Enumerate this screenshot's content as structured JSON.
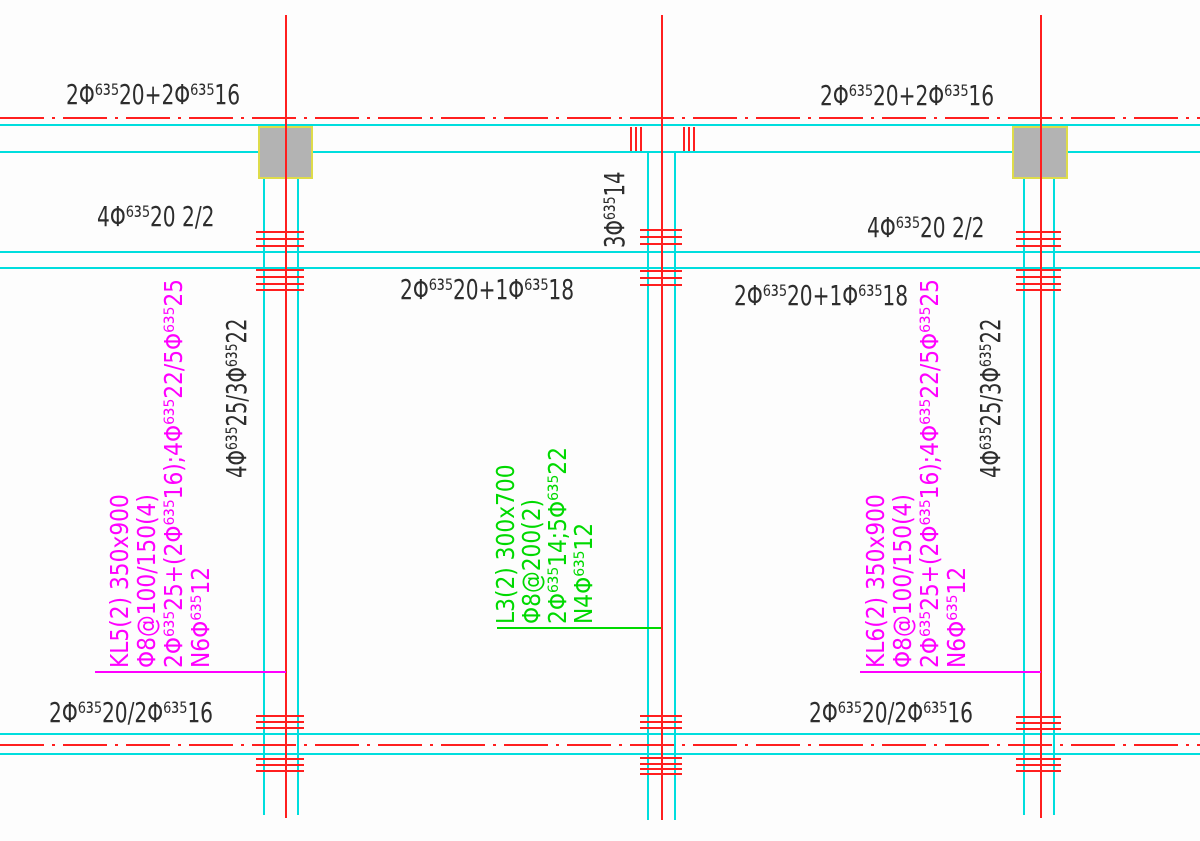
{
  "colors": {
    "grid_red": "#ff1f1f",
    "beam_cyan": "#00dede",
    "tag_magenta": "#ff00ff",
    "tag_green": "#00d900",
    "ink_black": "#2d2d2d",
    "column_fill_gray": "#b3b3b3",
    "column_border_yellow": "#dedc4a"
  },
  "labels": {
    "top_left": "2Φ⁶³⁵20+2Φ⁶³⁵16",
    "top_right": "2Φ⁶³⁵20+2Φ⁶³⁵16",
    "mid_left": "4Φ⁶³⁵20 2/2",
    "mid_right": "4Φ⁶³⁵20 2/2",
    "span_left": "2Φ⁶³⁵20+1Φ⁶³⁵18",
    "span_right": "2Φ⁶³⁵20+1Φ⁶³⁵18",
    "bottom_left": "2Φ⁶³⁵20/2Φ⁶³⁵16",
    "bottom_right": "2Φ⁶³⁵20/2Φ⁶³⁵16",
    "stirrup_mid": "3Φ⁶³⁵14",
    "side_left": "4Φ⁶³⁵25/3Φ⁶³⁵22",
    "side_right": "4Φ⁶³⁵25/3Φ⁶³⁵22"
  },
  "beam_blocks": {
    "kl5": {
      "lines": [
        "KL5(2) 350x900",
        "Φ8@100/150(4)",
        "2Φ⁶³⁵25+(2Φ⁶³⁵16);4Φ⁶³⁵22/5Φ⁶³⁵25",
        "N6Φ⁶³⁵12"
      ]
    },
    "kl6": {
      "lines": [
        "KL6(2) 350x900",
        "Φ8@100/150(4)",
        "2Φ⁶³⁵25+(2Φ⁶³⁵16);4Φ⁶³⁵22/5Φ⁶³⁵25",
        "N6Φ⁶³⁵12"
      ]
    },
    "l3": {
      "lines": [
        "L3(2) 300x700",
        "Φ8@200(2)",
        "2Φ⁶³⁵14;5Φ⁶³⁵22",
        "N4Φ⁶³⁵12"
      ]
    }
  }
}
